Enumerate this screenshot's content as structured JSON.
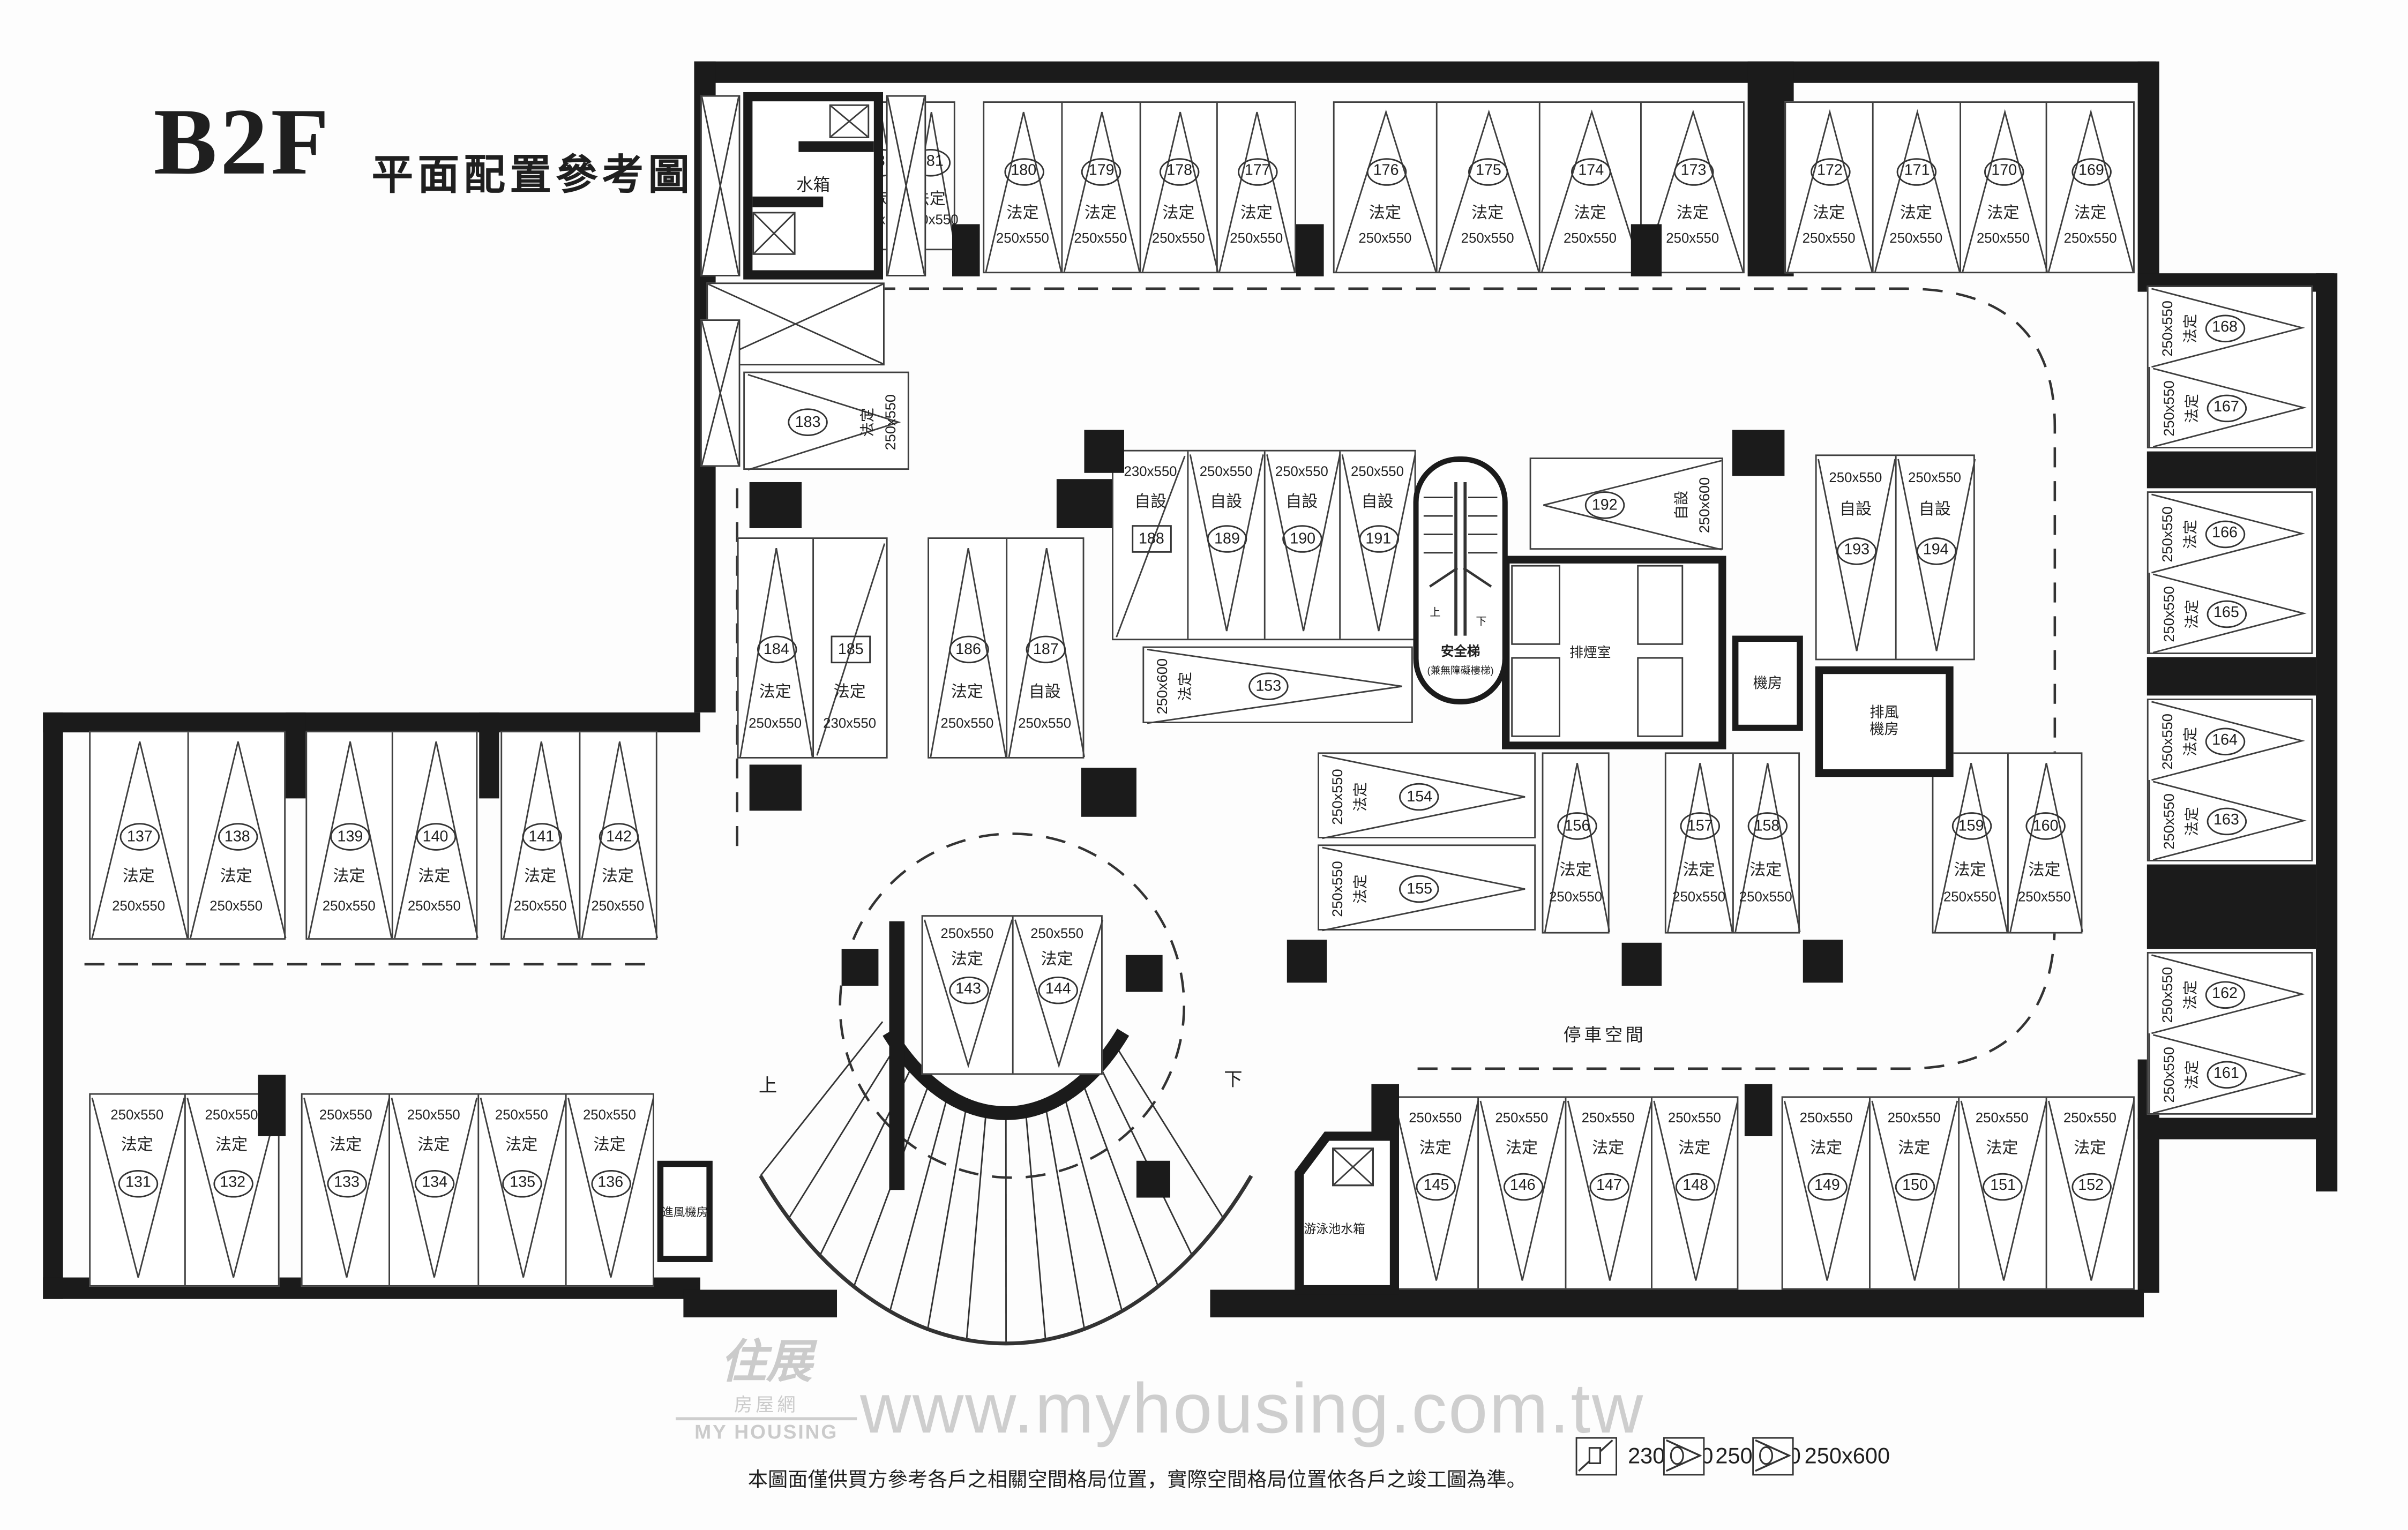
{
  "title": {
    "floor": "B2F",
    "subtitle": "平面配置參考圖"
  },
  "labels": {
    "parking_area": "停車空間",
    "up": "上",
    "down": "下"
  },
  "rooms": {
    "water_tank": "水箱",
    "pool_tank": "游泳池水箱",
    "intake_fan": "進風機房",
    "exhaust_fan_1": "排風",
    "exhaust_fan_2": "機房",
    "machine": "機房",
    "smoke": "排煙室",
    "stair_1": "安全梯",
    "stair_2": "(兼無障礙樓梯)"
  },
  "legend": {
    "items": [
      {
        "marker": "square",
        "label": "230x550"
      },
      {
        "marker": "circle",
        "label": "250x550"
      },
      {
        "marker": "circle",
        "label": "250x600"
      }
    ]
  },
  "disclaimer": "本圖面僅供買方參考各戶之相關空間格局位置，實際空間格局位置依各戶之竣工圖為準。",
  "watermark": {
    "brand_top": "住展",
    "brand_mid": "房屋網",
    "brand_bottom": "MY HOUSING",
    "url": "www.myhousing.com.tw"
  },
  "stall_groups": [
    {
      "id": "g-top-1",
      "stalls": [
        {
          "no": "182",
          "type": "法定",
          "size": "250x550",
          "marker": "circle"
        },
        {
          "no": "181",
          "type": "法定",
          "size": "250x550",
          "marker": "circle"
        }
      ]
    },
    {
      "id": "g-top-2",
      "stalls": [
        {
          "no": "180",
          "type": "法定",
          "size": "250x550",
          "marker": "circle"
        },
        {
          "no": "179",
          "type": "法定",
          "size": "250x550",
          "marker": "circle"
        },
        {
          "no": "178",
          "type": "法定",
          "size": "250x550",
          "marker": "circle"
        },
        {
          "no": "177",
          "type": "法定",
          "size": "250x550",
          "marker": "circle"
        }
      ]
    },
    {
      "id": "g-top-3",
      "stalls": [
        {
          "no": "176",
          "type": "法定",
          "size": "250x550",
          "marker": "circle"
        },
        {
          "no": "175",
          "type": "法定",
          "size": "250x550",
          "marker": "circle"
        },
        {
          "no": "174",
          "type": "法定",
          "size": "250x550",
          "marker": "circle"
        },
        {
          "no": "173",
          "type": "法定",
          "size": "250x550",
          "marker": "circle"
        }
      ]
    },
    {
      "id": "g-top-4",
      "stalls": [
        {
          "no": "172",
          "type": "法定",
          "size": "250x550",
          "marker": "circle"
        },
        {
          "no": "171",
          "type": "法定",
          "size": "250x550",
          "marker": "circle"
        },
        {
          "no": "170",
          "type": "法定",
          "size": "250x550",
          "marker": "circle"
        },
        {
          "no": "169",
          "type": "法定",
          "size": "250x550",
          "marker": "circle"
        }
      ]
    },
    {
      "id": "g-right-1",
      "stalls": [
        {
          "no": "168",
          "type": "法定",
          "size": "250x550",
          "marker": "circle"
        },
        {
          "no": "167",
          "type": "法定",
          "size": "250x550",
          "marker": "circle"
        }
      ]
    },
    {
      "id": "g-right-2",
      "stalls": [
        {
          "no": "166",
          "type": "法定",
          "size": "250x550",
          "marker": "circle"
        },
        {
          "no": "165",
          "type": "法定",
          "size": "250x550",
          "marker": "circle"
        }
      ]
    },
    {
      "id": "g-right-3",
      "stalls": [
        {
          "no": "164",
          "type": "法定",
          "size": "250x550",
          "marker": "circle"
        },
        {
          "no": "163",
          "type": "法定",
          "size": "250x550",
          "marker": "circle"
        }
      ]
    },
    {
      "id": "g-right-4",
      "stalls": [
        {
          "no": "162",
          "type": "法定",
          "size": "250x550",
          "marker": "circle"
        },
        {
          "no": "161",
          "type": "法定",
          "size": "250x550",
          "marker": "circle"
        }
      ]
    },
    {
      "id": "s-183",
      "stalls": [
        {
          "no": "183",
          "type": "法定",
          "size": "250x550",
          "marker": "circle"
        }
      ]
    },
    {
      "id": "g-ml-1",
      "stalls": [
        {
          "no": "184",
          "type": "法定",
          "size": "250x550",
          "marker": "circle"
        },
        {
          "no": "185",
          "type": "法定",
          "size": "230x550",
          "marker": "square"
        }
      ]
    },
    {
      "id": "g-ml-2",
      "stalls": [
        {
          "no": "186",
          "type": "法定",
          "size": "250x550",
          "marker": "circle"
        },
        {
          "no": "187",
          "type": "自設",
          "size": "250x550",
          "marker": "circle"
        }
      ]
    },
    {
      "id": "g-core",
      "stalls": [
        {
          "no": "188",
          "type": "自設",
          "size": "230x550",
          "marker": "square"
        },
        {
          "no": "189",
          "type": "自設",
          "size": "250x550",
          "marker": "circle"
        },
        {
          "no": "190",
          "type": "自設",
          "size": "250x550",
          "marker": "circle"
        },
        {
          "no": "191",
          "type": "自設",
          "size": "250x550",
          "marker": "circle"
        }
      ]
    },
    {
      "id": "s-153",
      "stalls": [
        {
          "no": "153",
          "type": "法定",
          "size": "250x600",
          "marker": "circle"
        }
      ]
    },
    {
      "id": "s-192",
      "stalls": [
        {
          "no": "192",
          "type": "自設",
          "size": "250x600",
          "marker": "circle"
        }
      ]
    },
    {
      "id": "g-cr",
      "stalls": [
        {
          "no": "193",
          "type": "自設",
          "size": "250x550",
          "marker": "circle"
        },
        {
          "no": "194",
          "type": "自設",
          "size": "250x550",
          "marker": "circle"
        }
      ]
    },
    {
      "id": "s-154",
      "stalls": [
        {
          "no": "154",
          "type": "法定",
          "size": "250x550",
          "marker": "circle"
        }
      ]
    },
    {
      "id": "s-155",
      "stalls": [
        {
          "no": "155",
          "type": "法定",
          "size": "250x550",
          "marker": "circle"
        }
      ]
    },
    {
      "id": "s-156",
      "stalls": [
        {
          "no": "156",
          "type": "法定",
          "size": "250x550",
          "marker": "circle"
        }
      ]
    },
    {
      "id": "g-mid-2",
      "stalls": [
        {
          "no": "157",
          "type": "法定",
          "size": "250x550",
          "marker": "circle"
        },
        {
          "no": "158",
          "type": "法定",
          "size": "250x550",
          "marker": "circle"
        }
      ]
    },
    {
      "id": "g-mid-3",
      "stalls": [
        {
          "no": "159",
          "type": "法定",
          "size": "250x550",
          "marker": "circle"
        },
        {
          "no": "160",
          "type": "法定",
          "size": "250x550",
          "marker": "circle"
        }
      ]
    },
    {
      "id": "g-143",
      "stalls": [
        {
          "no": "143",
          "type": "法定",
          "size": "250x550",
          "marker": "circle"
        },
        {
          "no": "144",
          "type": "法定",
          "size": "250x550",
          "marker": "circle"
        }
      ]
    },
    {
      "id": "g-lwt-1",
      "stalls": [
        {
          "no": "137",
          "type": "法定",
          "size": "250x550",
          "marker": "circle"
        },
        {
          "no": "138",
          "type": "法定",
          "size": "250x550",
          "marker": "circle"
        }
      ]
    },
    {
      "id": "g-lwt-2",
      "stalls": [
        {
          "no": "139",
          "type": "法定",
          "size": "250x550",
          "marker": "circle"
        },
        {
          "no": "140",
          "type": "法定",
          "size": "250x550",
          "marker": "circle"
        }
      ]
    },
    {
      "id": "g-lwt-3",
      "stalls": [
        {
          "no": "141",
          "type": "法定",
          "size": "250x550",
          "marker": "circle"
        },
        {
          "no": "142",
          "type": "法定",
          "size": "250x550",
          "marker": "circle"
        }
      ]
    },
    {
      "id": "g-lwb-1",
      "stalls": [
        {
          "no": "131",
          "type": "法定",
          "size": "250x550",
          "marker": "circle"
        },
        {
          "no": "132",
          "type": "法定",
          "size": "250x550",
          "marker": "circle"
        }
      ]
    },
    {
      "id": "g-lwb-2",
      "stalls": [
        {
          "no": "133",
          "type": "法定",
          "size": "250x550",
          "marker": "circle"
        },
        {
          "no": "134",
          "type": "法定",
          "size": "250x550",
          "marker": "circle"
        },
        {
          "no": "135",
          "type": "法定",
          "size": "250x550",
          "marker": "circle"
        },
        {
          "no": "136",
          "type": "法定",
          "size": "250x550",
          "marker": "circle"
        }
      ]
    },
    {
      "id": "g-bm",
      "stalls": [
        {
          "no": "145",
          "type": "法定",
          "size": "250x550",
          "marker": "circle"
        },
        {
          "no": "146",
          "type": "法定",
          "size": "250x550",
          "marker": "circle"
        },
        {
          "no": "147",
          "type": "法定",
          "size": "250x550",
          "marker": "circle"
        },
        {
          "no": "148",
          "type": "法定",
          "size": "250x550",
          "marker": "circle"
        }
      ]
    },
    {
      "id": "g-br",
      "stalls": [
        {
          "no": "149",
          "type": "法定",
          "size": "250x550",
          "marker": "circle"
        },
        {
          "no": "150",
          "type": "法定",
          "size": "250x550",
          "marker": "circle"
        },
        {
          "no": "151",
          "type": "法定",
          "size": "250x550",
          "marker": "circle"
        },
        {
          "no": "152",
          "type": "法定",
          "size": "250x550",
          "marker": "circle"
        }
      ]
    }
  ]
}
